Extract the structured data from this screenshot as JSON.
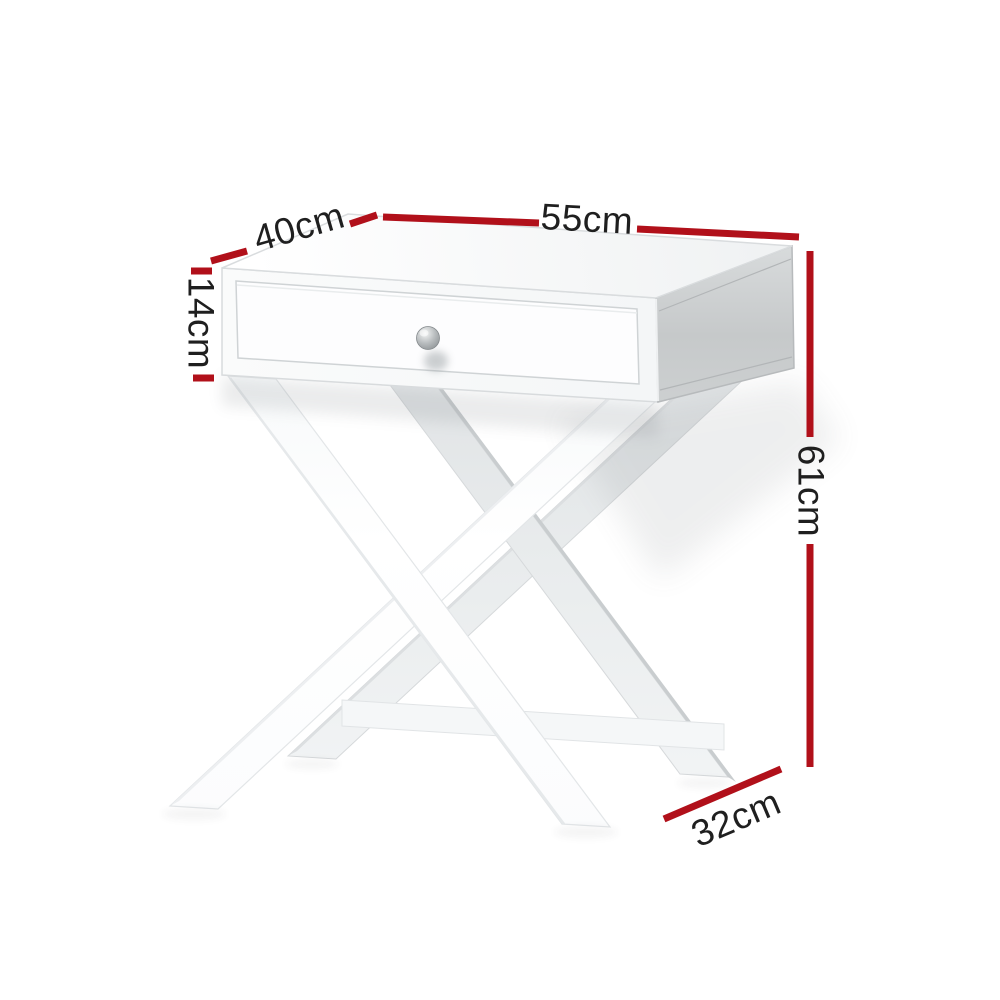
{
  "meta": {
    "type": "product-dimension-diagram",
    "background": "#ffffff"
  },
  "product": {
    "name": "X-Leg Bedside Table with Drawer",
    "description": "White side table with a single drawer, round metal knob, X-shaped cross legs and a lower stretcher bar",
    "finish_color": "#ffffff",
    "knob_color": "#9ea3a6"
  },
  "annotation_style": {
    "line_color": "#b1101a",
    "text_color": "#1f1f1f"
  },
  "measurements": {
    "top_width": {
      "label": "55cm",
      "value_cm": 55,
      "measures": "table top width (top right edge)"
    },
    "top_depth": {
      "label": "40cm",
      "value_cm": 40,
      "measures": "table top depth (top left edge)"
    },
    "drawer_height": {
      "label": "14cm",
      "value_cm": 14,
      "measures": "drawer box height (left side)"
    },
    "total_height": {
      "label": "61cm",
      "value_cm": 61,
      "measures": "overall height (right side)"
    },
    "base_depth": {
      "label": "32cm",
      "value_cm": 32,
      "measures": "leg base depth (bottom right)"
    }
  }
}
